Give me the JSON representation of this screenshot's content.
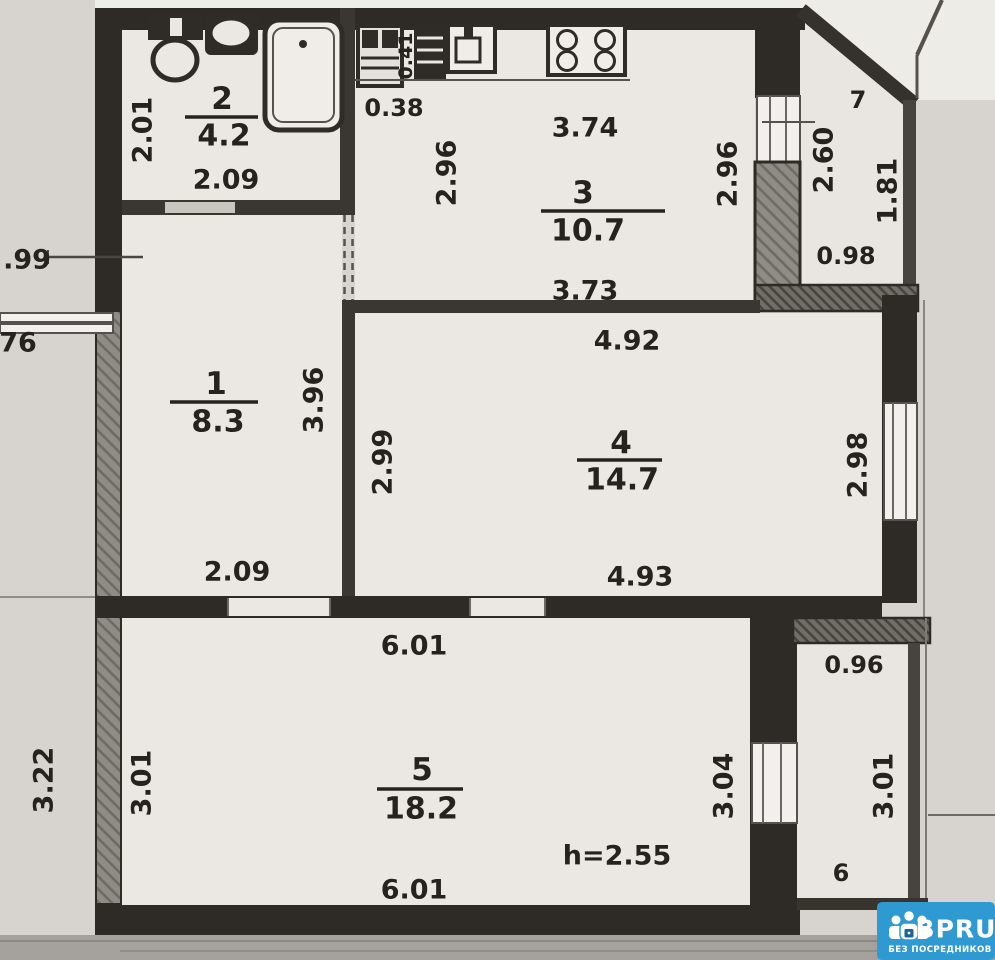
{
  "rooms": {
    "hallway": {
      "number": "1",
      "area": "8.3",
      "width_bottom": "2.09",
      "height_right": "3.96"
    },
    "bathroom": {
      "number": "2",
      "area": "4.2",
      "height_left": "2.01",
      "width_bottom": "2.09",
      "gap_right": "0.38",
      "gap_top": "0.41"
    },
    "kitchen": {
      "number": "3",
      "area": "10.7",
      "width_top": "3.74",
      "height_left": "2.96",
      "height_right": "2.96",
      "width_bottom": "3.73"
    },
    "bedroom": {
      "number": "4",
      "area": "14.7",
      "width_top": "4.92",
      "height_left": "2.99",
      "height_right": "2.98",
      "width_bottom": "4.93"
    },
    "living": {
      "number": "5",
      "area": "18.2",
      "width_top": "6.01",
      "height_left": "3.01",
      "width_bottom": "6.01",
      "ceiling_note": "h=2.55"
    },
    "balcony_top": {
      "number": "7",
      "height_left": "2.60",
      "height_right": "1.81",
      "width_bottom": "0.98"
    },
    "balcony_bottom": {
      "number": "6",
      "width_top": "0.96",
      "height_left": "3.04",
      "height_right": "3.01"
    }
  },
  "neighbor": {
    "dim_top": ".99",
    "dim_window": "76",
    "dim_bottom": "3.22"
  },
  "watermark": {
    "brand": "BPRU",
    "tagline": "БЕЗ ПОСРЕДНИКОВ",
    "bg_color": "#2f9ad2"
  },
  "colors": {
    "paper": "#d7d4cf",
    "plan_fill": "#ebe8e3",
    "wall": "#2e2b27",
    "accent_blue": "#2f9ad2"
  }
}
